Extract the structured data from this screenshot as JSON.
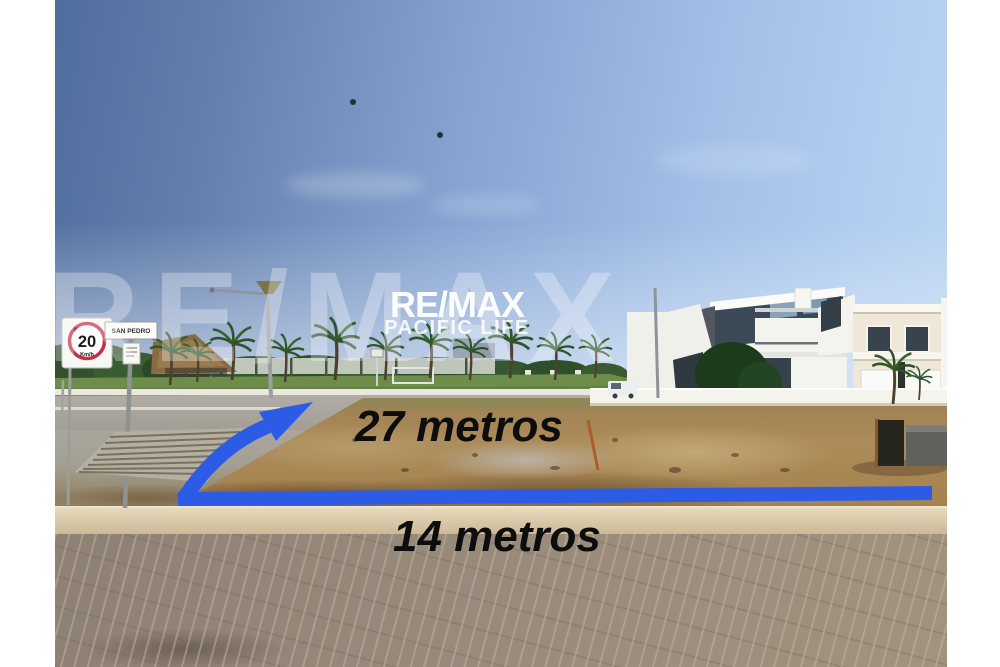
{
  "watermark": {
    "brand": "RE/MAX",
    "tagline": "PACIFIC LIFE",
    "background_text": "RE/MAX"
  },
  "measurements": {
    "side_label": "27 metros",
    "front_label": "14 metros"
  },
  "street_signs": {
    "speed_limit_value": "20",
    "speed_limit_unit": "Km/h",
    "street_name": "SAN PEDRO"
  },
  "colors": {
    "measure_line": "#2c5be6",
    "sky_top": "#4f6d9d",
    "dirt": "#a8854f",
    "pavement": "#93867a"
  }
}
